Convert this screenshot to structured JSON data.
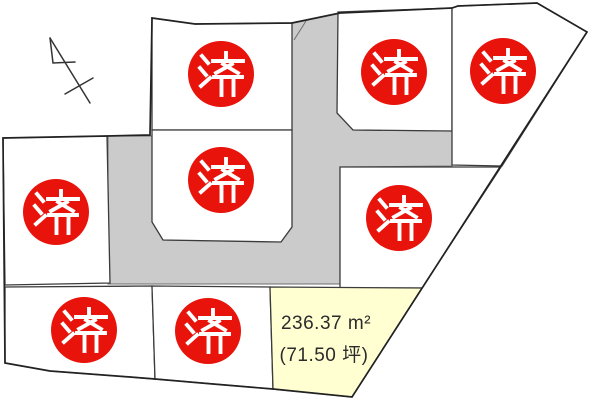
{
  "map": {
    "kind": "land-subdivision-plot-map",
    "icons": {
      "north_arrow": "north-arrow-icon",
      "sold_stamp": "sold-stamp-icon"
    },
    "colors": {
      "sold_stamp_red": "#e8130b",
      "stamp_text_white": "#ffffff",
      "road_gray": "#cbcbcb",
      "available_plot_yellow": "#ffffd2",
      "plot_fill_white": "#ffffff",
      "boundary_line": "#2a2a2a"
    },
    "sold_stamp_text": "済",
    "sold_count": 8,
    "sold_plots": [
      {
        "name": "plot-upper-left",
        "status": "済"
      },
      {
        "name": "plot-middle-top",
        "status": "済"
      },
      {
        "name": "plot-middle-lower",
        "status": "済"
      },
      {
        "name": "plot-top-right-inner",
        "status": "済"
      },
      {
        "name": "plot-top-right-corner",
        "status": "済"
      },
      {
        "name": "plot-right-middle",
        "status": "済"
      },
      {
        "name": "plot-bottom-left",
        "status": "済"
      },
      {
        "name": "plot-bottom-middle",
        "status": "済"
      }
    ],
    "available_plot": {
      "name": "plot-bottom-right-available",
      "area_m2": "236.37 m²",
      "area_tsubo": "(71.50 坪)"
    }
  }
}
